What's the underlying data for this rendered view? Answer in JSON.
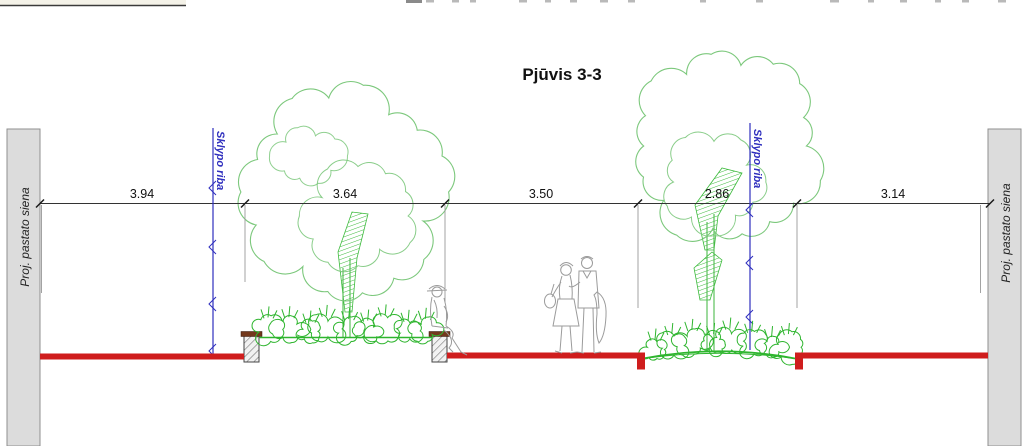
{
  "drawing": {
    "title": "Pjūvis 3-3",
    "walls": {
      "left": "Proj. pastato siena",
      "right": "Proj. pastato siena"
    },
    "boundaries": {
      "left": "Sklypo riba",
      "right": "Sklypo riba"
    },
    "dimensions": {
      "values": [
        "3.94",
        "3.64",
        "3.50",
        "2.86",
        "3.14"
      ]
    }
  },
  "colors": {
    "ground_red": "#cf1d1d",
    "tree_green": "#7cc87c",
    "shrub_green": "#2eb52e",
    "trunk_green": "#4dbb4d",
    "boundary_blue": "#2f2fbe",
    "wall_gray": "#dcdcdc",
    "wall_border_gray": "#8f8f8f",
    "curb_cap_brown": "#73381c",
    "figure_gray": "#9b9b9b",
    "dim_gray": "#333333"
  }
}
